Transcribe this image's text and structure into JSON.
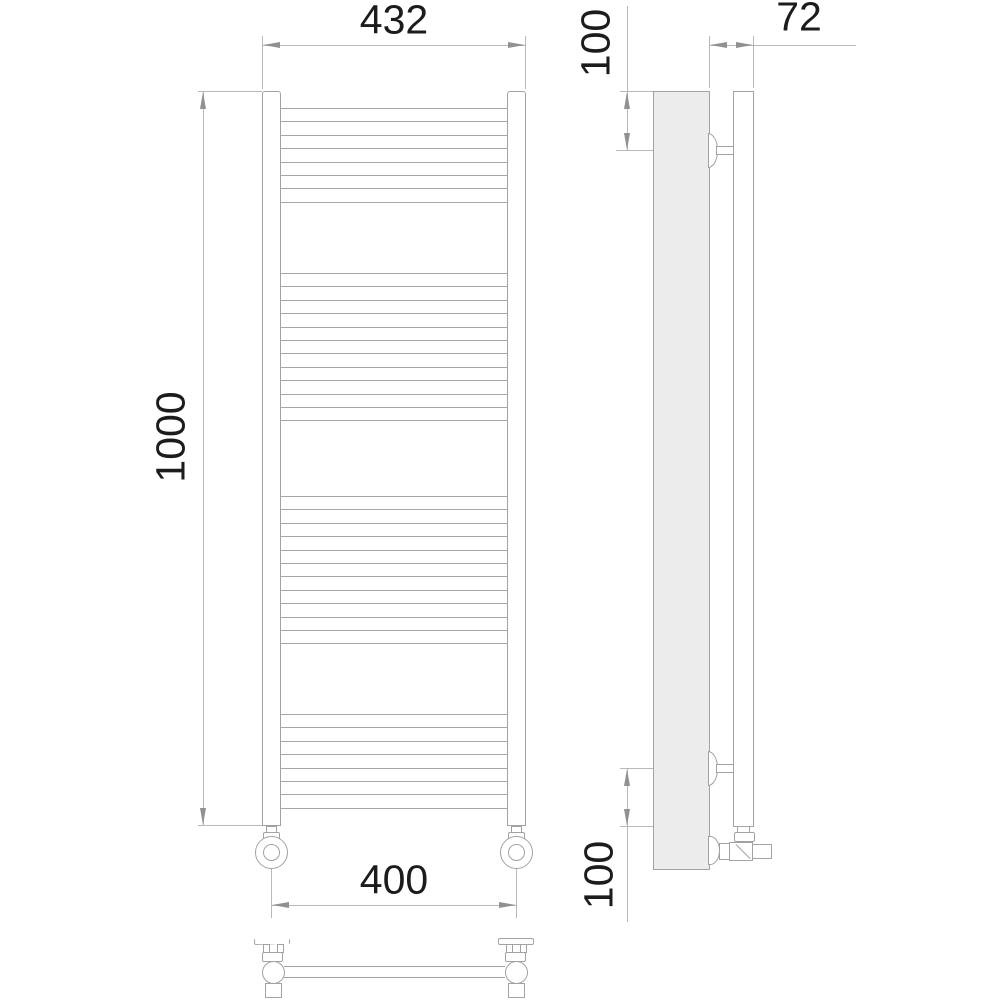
{
  "dimensions": {
    "front_top_width": "432",
    "front_height": "1000",
    "front_bottom_width": "400",
    "side_depth": "72",
    "side_top_offset": "100",
    "side_bottom_offset": "100"
  },
  "structure": {
    "rung_groups": [
      {
        "y_start": 108,
        "count": 8,
        "spacing": 13.4
      },
      {
        "y_start": 273,
        "count": 12,
        "spacing": 13.4
      },
      {
        "y_start": 496,
        "count": 12,
        "spacing": 13.4
      },
      {
        "y_start": 714,
        "count": 8,
        "spacing": 13.4
      }
    ],
    "rung_line_total": 40
  },
  "colors": {
    "background": "#ffffff",
    "object_line": "#a4a7a9",
    "dimension_line": "#b6b8ba",
    "arrow": "#8f9294",
    "text": "#1c1c1c",
    "wall_panel_fill": "#ececec"
  }
}
